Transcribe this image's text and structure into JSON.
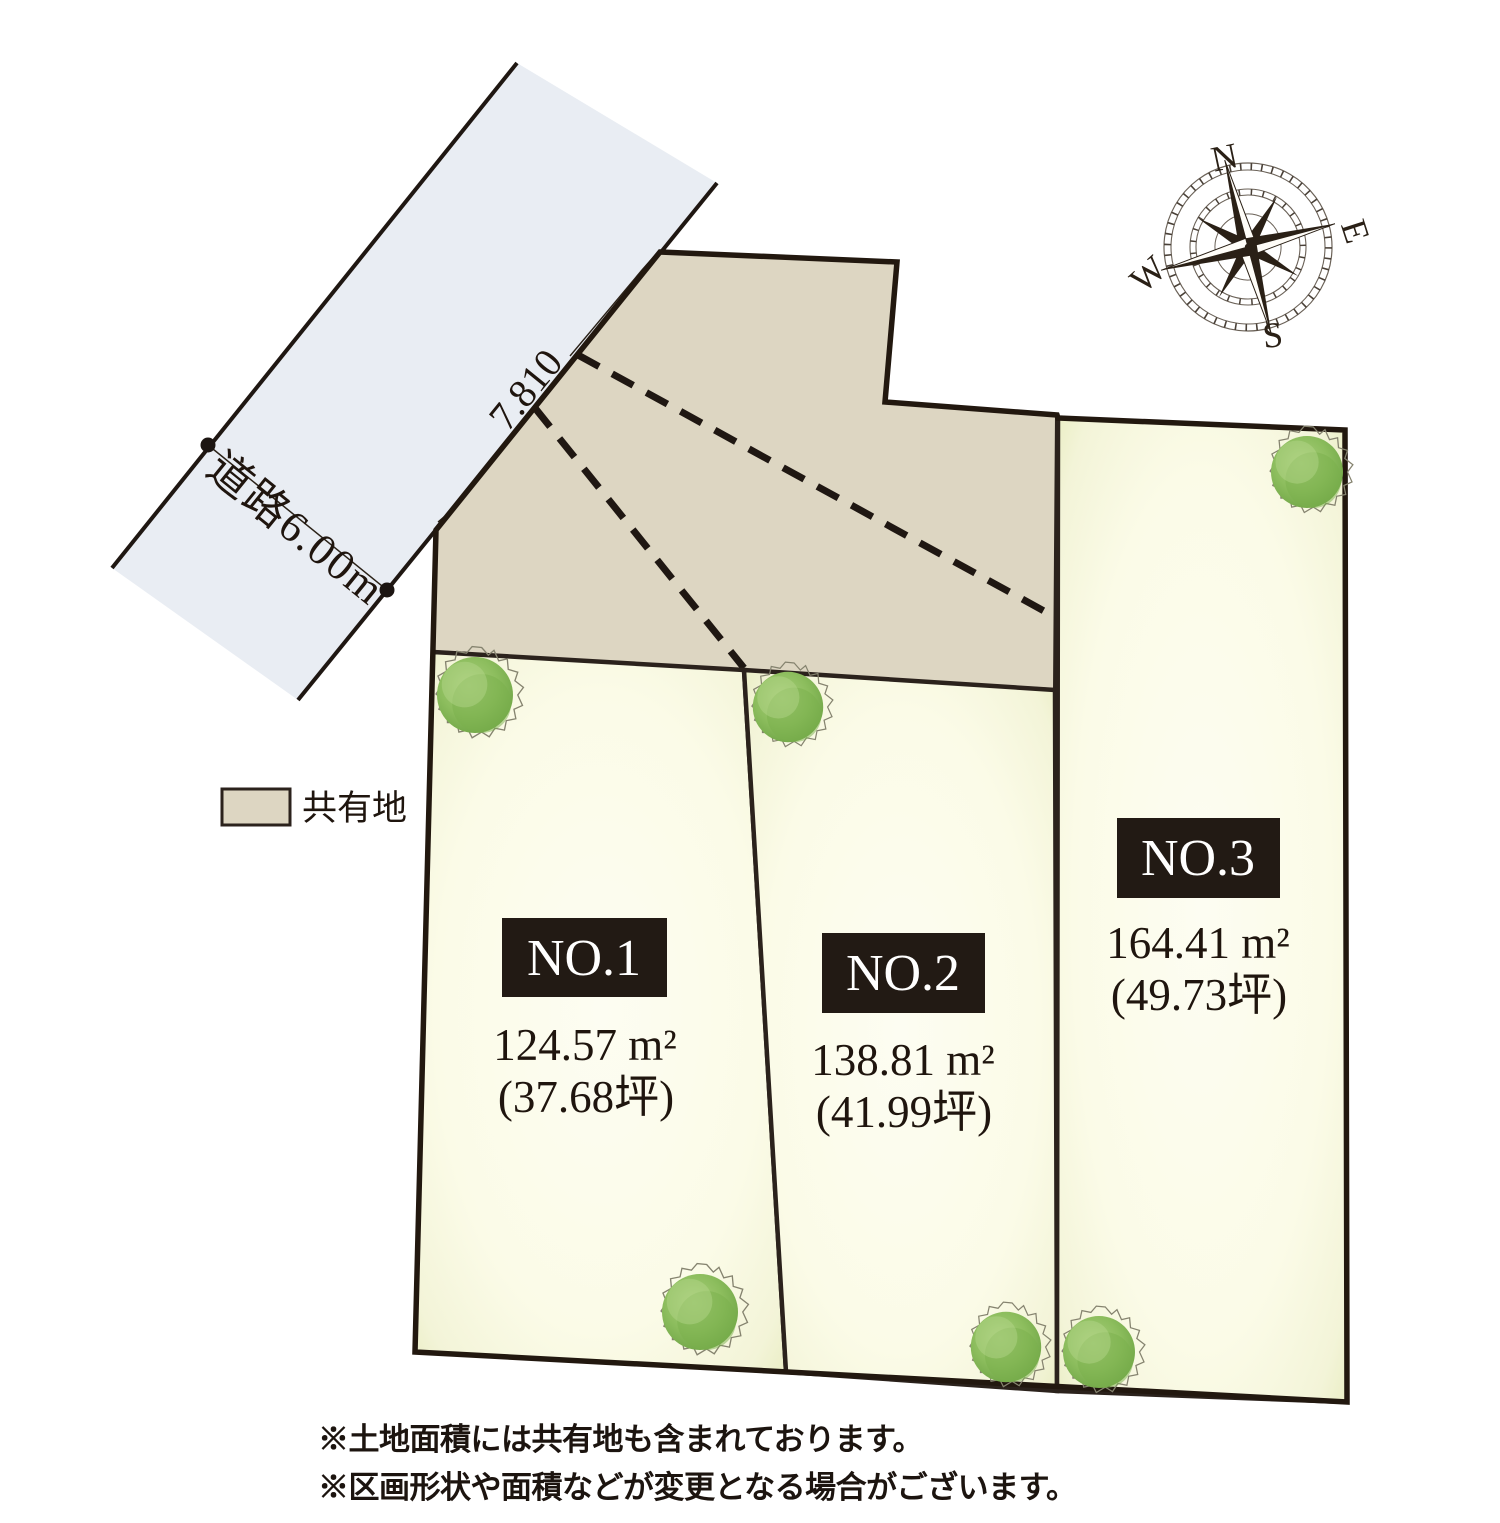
{
  "road": {
    "label": "道路6.00m",
    "frontage_dimension": "7.810"
  },
  "legend": {
    "shared_label": "共有地"
  },
  "compass": {
    "n": "N",
    "e": "E",
    "s": "S",
    "w": "W"
  },
  "lots": [
    {
      "id": "NO.1",
      "area": "124.57 m²",
      "tsubo": "(37.68坪)"
    },
    {
      "id": "NO.2",
      "area": "138.81 m²",
      "tsubo": "(41.99坪)"
    },
    {
      "id": "NO.3",
      "area": "164.41 m²",
      "tsubo": "(49.73坪)"
    }
  ],
  "notes": [
    "※土地面積には共有地も含まれております。",
    "※区画形状や面積などが変更となる場合がございます。"
  ],
  "colors": {
    "road": "#e9edf3",
    "shared": "#ddd6c2",
    "lot_border": "#2b221c",
    "label_bg": "#221a14",
    "label_text": "#ffffff",
    "text": "#1f150e",
    "tree_green": "#8cbd5d"
  }
}
